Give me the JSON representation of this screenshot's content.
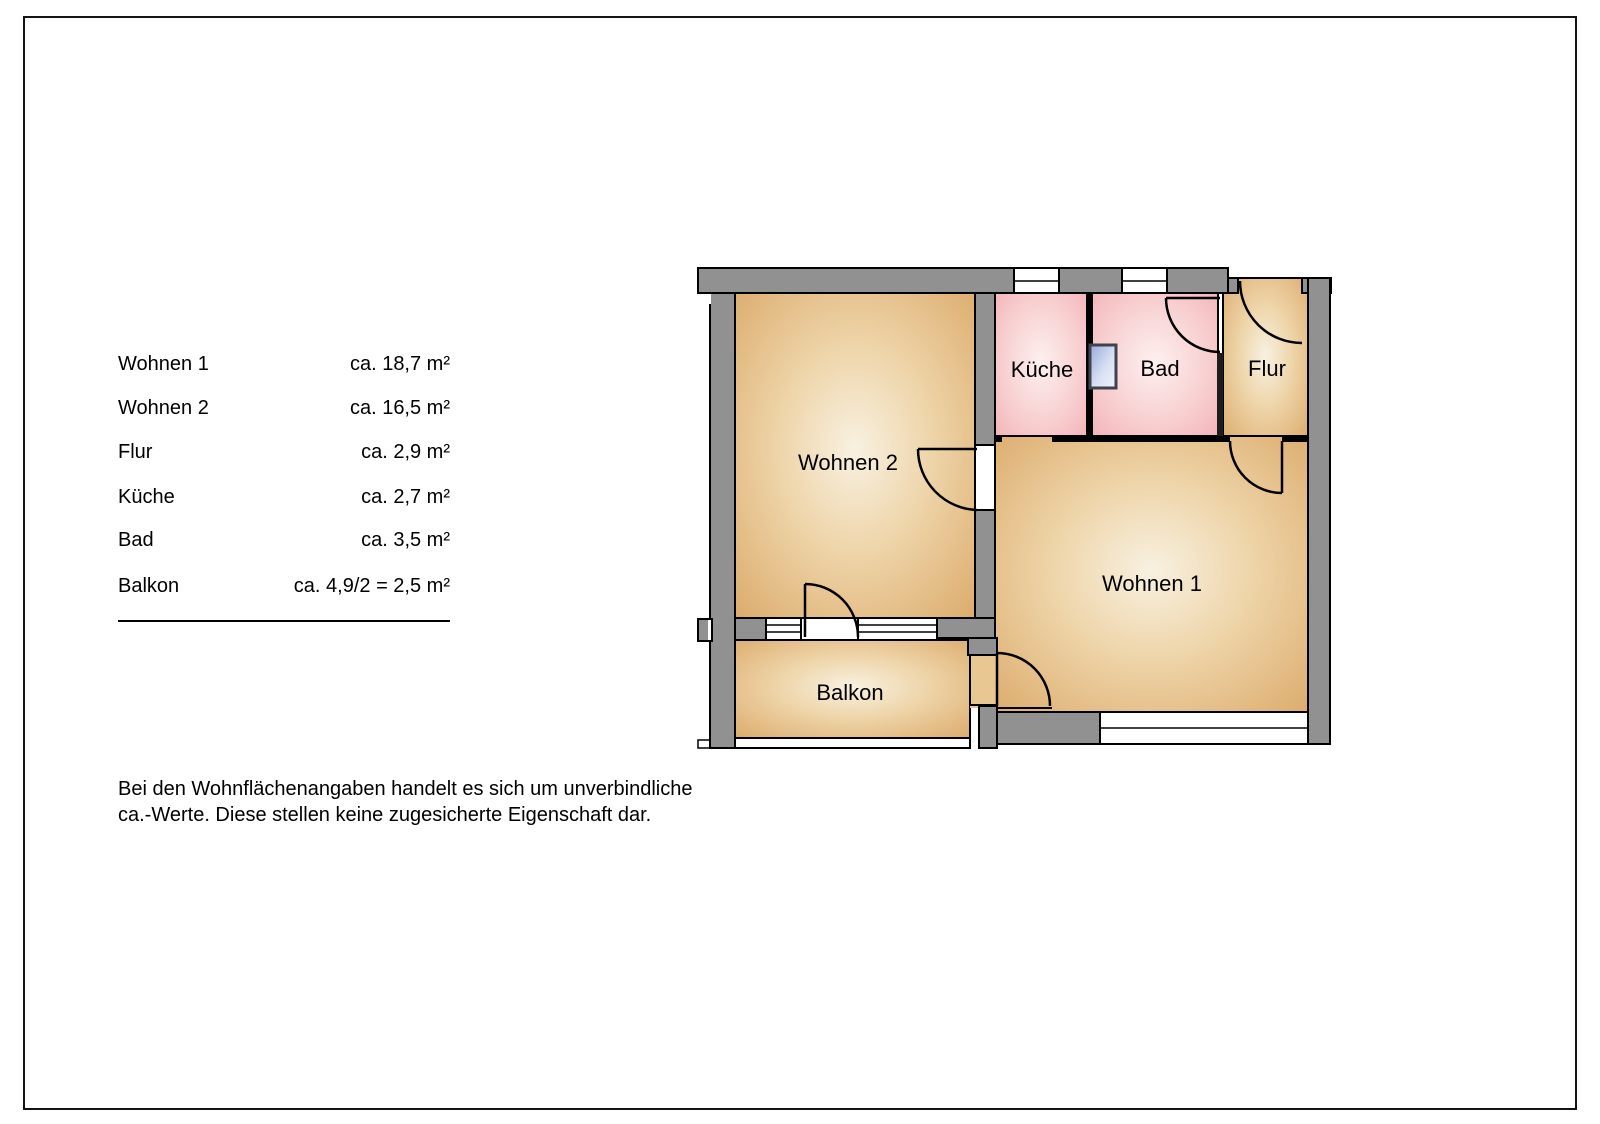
{
  "legend": {
    "rows": [
      {
        "label": "Wohnen 1",
        "value": "ca. 18,7 m²"
      },
      {
        "label": "Wohnen 2",
        "value": "ca. 16,5 m²"
      },
      {
        "label": "Flur",
        "value": "ca. 2,9 m²"
      },
      {
        "label": "Küche",
        "value": "ca. 2,7 m²"
      },
      {
        "label": "Bad",
        "value": "ca. 3,5 m²"
      },
      {
        "label": "Balkon",
        "value": "ca. 4,9/2 = 2,5 m²"
      }
    ]
  },
  "disclaimer": {
    "line1": "Bei den Wohnflächenangaben handelt es sich um unverbindliche",
    "line2": "ca.-Werte. Diese stellen keine zugesicherte Eigenschaft dar."
  },
  "floorplan": {
    "room_labels": {
      "wohnen1": "Wohnen 1",
      "wohnen2": "Wohnen 2",
      "kueche": "Küche",
      "bad": "Bad",
      "flur": "Flur",
      "balkon": "Balkon"
    },
    "colors": {
      "wall_gray": "#919191",
      "outline": "#000000",
      "room_tan_edge": "#dcab6c",
      "room_tan_center": "#f7efdf",
      "room_pink_edge": "#f3b1b5",
      "room_pink_center": "#fcefee",
      "glass_blue": "#98a9d9"
    }
  }
}
